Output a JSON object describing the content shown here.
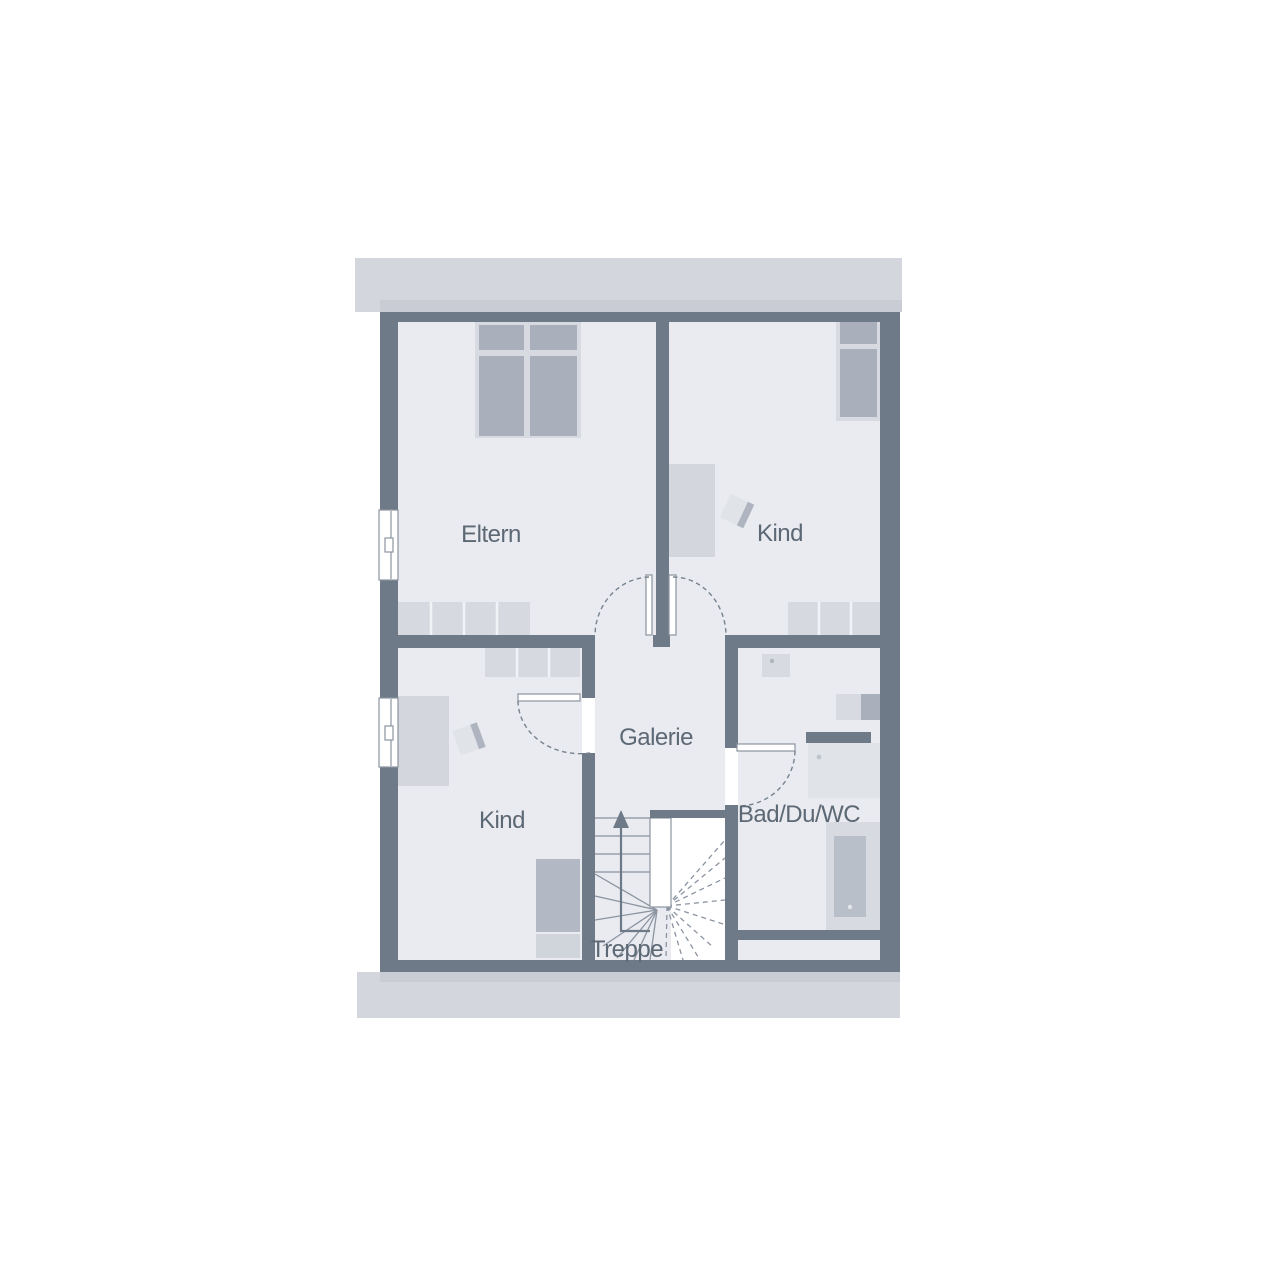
{
  "plan": {
    "type": "floor-plan",
    "floor_name_hint": "upper floor (attic) of single family house",
    "rooms": [
      {
        "id": "eltern",
        "label": "Eltern"
      },
      {
        "id": "kind-top",
        "label": "Kind"
      },
      {
        "id": "kind-bottom",
        "label": "Kind"
      },
      {
        "id": "galerie",
        "label": "Galerie"
      },
      {
        "id": "bad",
        "label": "Bad/Du/WC"
      },
      {
        "id": "treppe",
        "label": "Treppe"
      }
    ],
    "stairs": {
      "direction_arrow": "up",
      "style": "winder stair with open well"
    },
    "window_count": 2,
    "door_swings": 4
  },
  "palette": {
    "paper": "#ffffff",
    "wall": "#6f7a88",
    "floor": "#e9ebf0",
    "band": "#d3d6dd",
    "band_shadow": "#c9ccd4",
    "furn_light": "#d7dae1",
    "furn_mid": "#c3c8d1",
    "furn_dark": "#a9afbb",
    "line": "#8b94a1",
    "text": "#5d6875"
  }
}
